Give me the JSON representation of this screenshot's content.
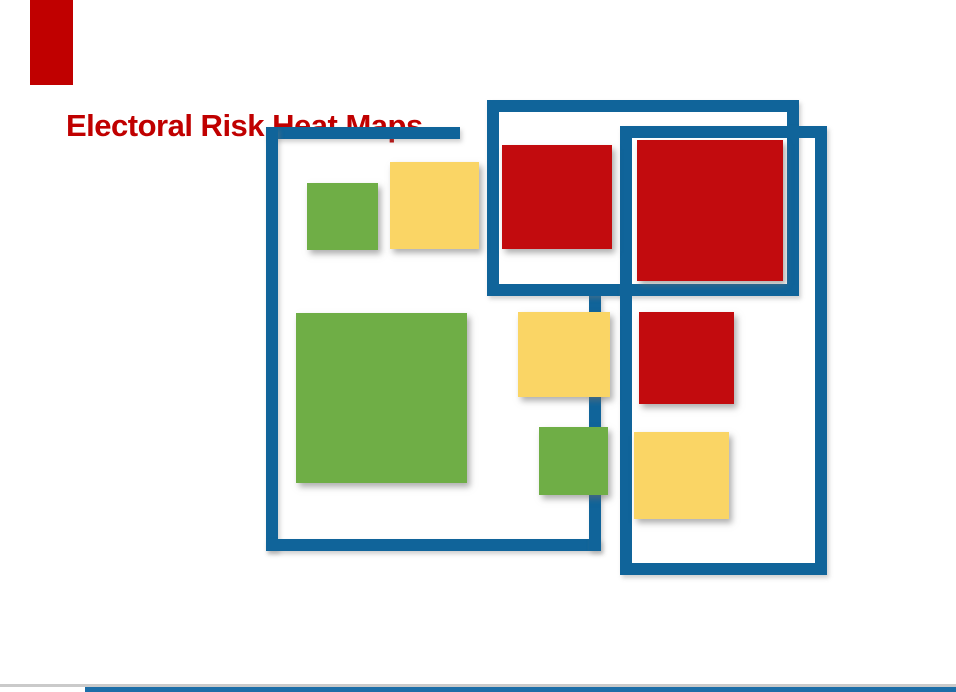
{
  "slide": {
    "title": "Electoral Risk Heat Maps",
    "title_color": "#C00000",
    "background": "#FFFFFF"
  },
  "palette": {
    "frame_blue": "#10649A",
    "risk_high_red": "#C20B0E",
    "risk_medium_yellow": "#FAD565",
    "risk_low_green": "#6FAE46",
    "decoration_red": "#C00000",
    "decoration_blue": "#1C6EA8",
    "decoration_gray": "#CACACA"
  },
  "decorations": {
    "red_corner_bar": {
      "x": 30,
      "y": 0,
      "w": 43,
      "h": 85
    },
    "bottom_gray_rule": {
      "x": 0,
      "y": 684,
      "w": 956,
      "h": 3
    },
    "bottom_blue_line": {
      "x": 85,
      "y": 687,
      "w": 871,
      "h": 5
    }
  },
  "frames": [
    {
      "name": "left-frame-top-border",
      "type": "segment",
      "x": 266,
      "y": 127,
      "w": 194,
      "h": 12
    },
    {
      "name": "left-frame-left-border",
      "type": "segment",
      "x": 266,
      "y": 127,
      "w": 12,
      "h": 424
    },
    {
      "name": "left-frame-bottom-border",
      "type": "segment",
      "x": 266,
      "y": 539,
      "w": 335,
      "h": 12
    },
    {
      "name": "left-frame-right-border",
      "type": "segment",
      "x": 589,
      "y": 296,
      "w": 12,
      "h": 255
    },
    {
      "name": "middle-frame",
      "type": "outline",
      "x": 487,
      "y": 100,
      "w": 312,
      "h": 196,
      "border": 12
    },
    {
      "name": "right-frame",
      "type": "outline",
      "x": 620,
      "y": 126,
      "w": 207,
      "h": 449,
      "border": 12
    }
  ],
  "squares": [
    {
      "name": "green-square-top",
      "risk": "low",
      "color": "#6FAE46",
      "x": 307,
      "y": 183,
      "w": 71,
      "h": 67
    },
    {
      "name": "yellow-square-top",
      "risk": "medium",
      "color": "#FAD565",
      "x": 390,
      "y": 162,
      "w": 89,
      "h": 87
    },
    {
      "name": "red-square-top",
      "risk": "high",
      "color": "#C20B0E",
      "x": 502,
      "y": 145,
      "w": 110,
      "h": 104
    },
    {
      "name": "red-square-large",
      "risk": "high",
      "color": "#C20B0E",
      "x": 637,
      "y": 140,
      "w": 146,
      "h": 141
    },
    {
      "name": "green-square-large",
      "risk": "low",
      "color": "#6FAE46",
      "x": 296,
      "y": 313,
      "w": 171,
      "h": 170
    },
    {
      "name": "yellow-square-middle",
      "risk": "medium",
      "color": "#FAD565",
      "x": 518,
      "y": 312,
      "w": 92,
      "h": 85
    },
    {
      "name": "red-square-middle",
      "risk": "high",
      "color": "#C20B0E",
      "x": 639,
      "y": 312,
      "w": 95,
      "h": 92
    },
    {
      "name": "green-square-bottom",
      "risk": "low",
      "color": "#6FAE46",
      "x": 539,
      "y": 427,
      "w": 69,
      "h": 68
    },
    {
      "name": "yellow-square-bottom",
      "risk": "medium",
      "color": "#FAD565",
      "x": 634,
      "y": 432,
      "w": 95,
      "h": 87
    }
  ]
}
